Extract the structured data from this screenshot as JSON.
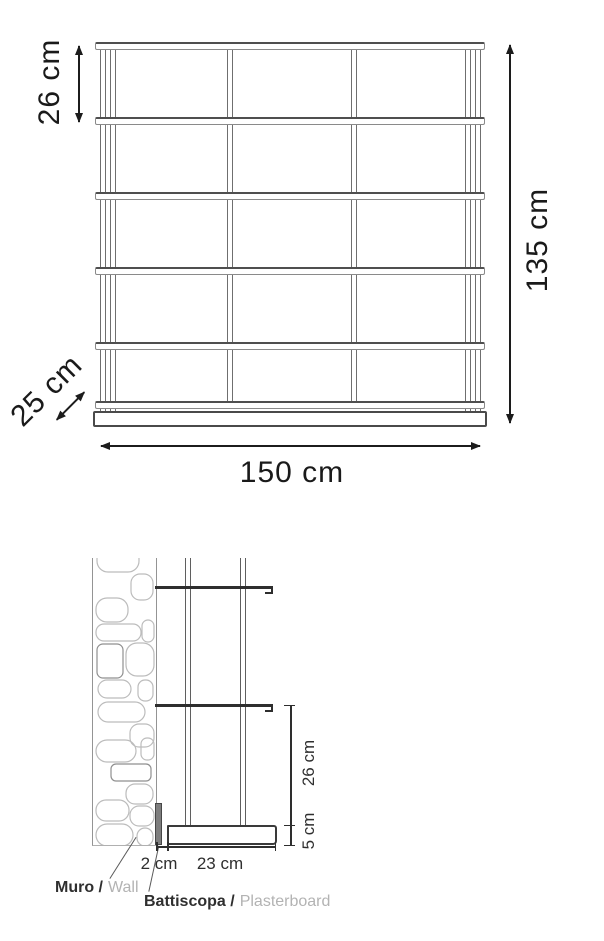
{
  "front_view": {
    "shelf_spacing_label": "26 cm",
    "height_label": "135 cm",
    "width_label": "150 cm",
    "depth_label": "25 cm"
  },
  "side_view": {
    "shelf_spacing_label": "26 cm",
    "plinth_height_label": "5 cm",
    "skirting_thickness_label": "2 cm",
    "base_depth_label": "23 cm",
    "wall_label_it": "Muro /",
    "wall_label_en": "Wall",
    "skirting_label_it": "Battiscopa /",
    "skirting_label_en": "Plasterboard"
  },
  "colors": {
    "dimension_ink": "#1c1c1c",
    "drawing_line": "#5a5a5a",
    "stone_outline": "#bcbcbc",
    "skirting_fill": "#7d7d7d",
    "muted_text": "#b3b3b3"
  }
}
